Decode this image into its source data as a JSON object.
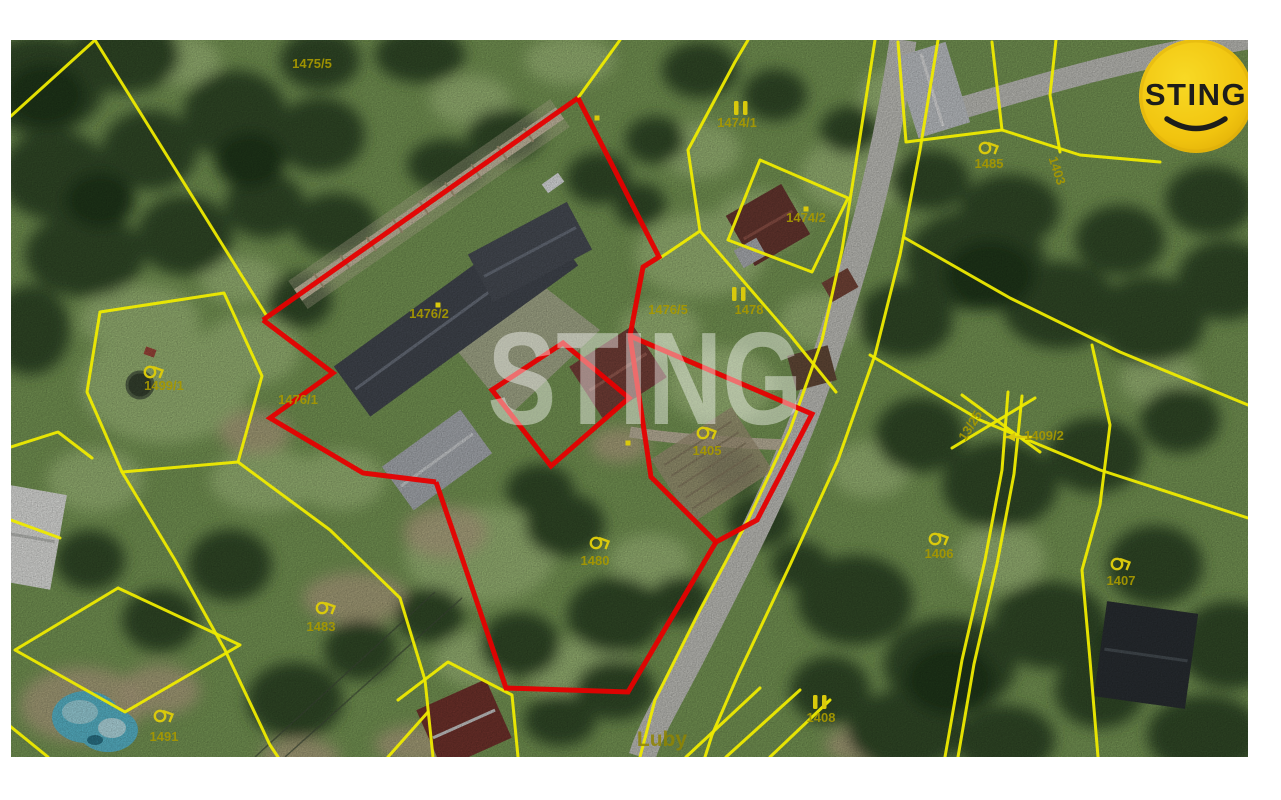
{
  "map": {
    "colors": {
      "parcel_line": "#eeea00",
      "parcel_label": "#a59700",
      "parcel_label_bright": "#d9c90c",
      "highlight_outline": "#e60000",
      "watermark": "rgba(255,255,255,0.42)",
      "road": "#cfcfc9",
      "place_label_color": "#8f8400"
    },
    "watermark_text": "STING",
    "place_label": {
      "text": "Luby",
      "x": 662,
      "y": 746
    },
    "labels": [
      {
        "text": "1475/5",
        "x": 312,
        "y": 68
      },
      {
        "text": "1474/1",
        "x": 737,
        "y": 127
      },
      {
        "text": "1474/2",
        "x": 806,
        "y": 222
      },
      {
        "text": "1476/2",
        "x": 429,
        "y": 318
      },
      {
        "text": "1476/5",
        "x": 668,
        "y": 314
      },
      {
        "text": "1478",
        "x": 749,
        "y": 314
      },
      {
        "text": "1476/1",
        "x": 298,
        "y": 404
      },
      {
        "text": "1499/1",
        "x": 164,
        "y": 390
      },
      {
        "text": "1405",
        "x": 707,
        "y": 455
      },
      {
        "text": "1480",
        "x": 595,
        "y": 565
      },
      {
        "text": "1483",
        "x": 321,
        "y": 631
      },
      {
        "text": "1491",
        "x": 164,
        "y": 741
      },
      {
        "text": "1406",
        "x": 939,
        "y": 558
      },
      {
        "text": "1407",
        "x": 1121,
        "y": 585
      },
      {
        "text": "1409/2",
        "x": 1044,
        "y": 440
      },
      {
        "text": "13/25",
        "x": 974,
        "y": 428,
        "rot": -58
      },
      {
        "text": "1403",
        "x": 1053,
        "y": 172,
        "rot": 72
      },
      {
        "text": "1485",
        "x": 989,
        "y": 168
      },
      {
        "text": "1408",
        "x": 821,
        "y": 722
      }
    ],
    "double_bar_marks": [
      [
        741,
        108
      ],
      [
        739,
        294
      ],
      [
        820,
        702
      ],
      [
        1229,
        62
      ]
    ],
    "dot_marks": [
      [
        438,
        305
      ],
      [
        806,
        209
      ],
      [
        597,
        118
      ],
      [
        628,
        443
      ]
    ],
    "orchard_symbols": [
      [
        150,
        372
      ],
      [
        703,
        433
      ],
      [
        596,
        543
      ],
      [
        322,
        608
      ],
      [
        160,
        716
      ],
      [
        935,
        539
      ],
      [
        1117,
        564
      ],
      [
        985,
        148
      ]
    ],
    "arrow": {
      "from": [
        1032,
        437
      ],
      "to": [
        1006,
        437
      ]
    },
    "parcel_lines": [
      [
        [
          95,
          40
        ],
        [
          268,
          318
        ]
      ],
      [
        [
          11,
          116
        ],
        [
          95,
          40
        ]
      ],
      [
        [
          100,
          312
        ],
        [
          224,
          293
        ],
        [
          262,
          376
        ],
        [
          238,
          462
        ],
        [
          122,
          472
        ],
        [
          87,
          392
        ],
        [
          100,
          312
        ]
      ],
      [
        [
          238,
          462
        ],
        [
          330,
          530
        ],
        [
          400,
          598
        ],
        [
          425,
          680
        ],
        [
          433,
          757
        ]
      ],
      [
        [
          122,
          472
        ],
        [
          175,
          560
        ],
        [
          225,
          650
        ],
        [
          270,
          745
        ],
        [
          278,
          757
        ]
      ],
      [
        [
          118,
          588
        ],
        [
          240,
          645
        ],
        [
          125,
          712
        ],
        [
          15,
          650
        ],
        [
          118,
          588
        ]
      ],
      [
        [
          0,
          718
        ],
        [
          48,
          757
        ]
      ],
      [
        [
          11,
          447
        ],
        [
          58,
          432
        ],
        [
          92,
          458
        ]
      ],
      [
        [
          11,
          520
        ],
        [
          60,
          538
        ]
      ],
      [
        [
          620,
          40
        ],
        [
          578,
          98
        ]
      ],
      [
        [
          660,
          258
        ],
        [
          700,
          231
        ],
        [
          790,
          335
        ],
        [
          836,
          392
        ]
      ],
      [
        [
          700,
          231
        ],
        [
          688,
          150
        ],
        [
          735,
          62
        ],
        [
          748,
          40
        ]
      ],
      [
        [
          760,
          160
        ],
        [
          848,
          198
        ],
        [
          812,
          272
        ],
        [
          728,
          240
        ],
        [
          760,
          160
        ]
      ],
      [
        [
          875,
          40
        ],
        [
          858,
          150
        ],
        [
          842,
          250
        ],
        [
          822,
          340
        ],
        [
          790,
          430
        ],
        [
          748,
          520
        ],
        [
          700,
          610
        ],
        [
          655,
          700
        ],
        [
          640,
          757
        ]
      ],
      [
        [
          938,
          40
        ],
        [
          920,
          150
        ],
        [
          900,
          255
        ],
        [
          875,
          355
        ],
        [
          838,
          460
        ],
        [
          790,
          565
        ],
        [
          738,
          675
        ],
        [
          712,
          735
        ],
        [
          705,
          757
        ]
      ],
      [
        [
          898,
          42
        ],
        [
          906,
          142
        ],
        [
          1002,
          130
        ],
        [
          992,
          42
        ]
      ],
      [
        [
          1002,
          130
        ],
        [
          1080,
          155
        ],
        [
          1160,
          162
        ]
      ],
      [
        [
          1056,
          40
        ],
        [
          1050,
          95
        ],
        [
          1060,
          152
        ]
      ],
      [
        [
          905,
          238
        ],
        [
          1010,
          298
        ],
        [
          1120,
          352
        ],
        [
          1248,
          405
        ]
      ],
      [
        [
          870,
          355
        ],
        [
          980,
          420
        ],
        [
          1100,
          470
        ],
        [
          1248,
          518
        ]
      ],
      [
        [
          1008,
          392
        ],
        [
          1002,
          470
        ],
        [
          985,
          560
        ],
        [
          962,
          660
        ],
        [
          945,
          757
        ]
      ],
      [
        [
          1022,
          396
        ],
        [
          1014,
          474
        ],
        [
          997,
          564
        ],
        [
          974,
          664
        ],
        [
          958,
          757
        ]
      ],
      [
        [
          952,
          448
        ],
        [
          1035,
          398
        ]
      ],
      [
        [
          962,
          395
        ],
        [
          1040,
          452
        ]
      ],
      [
        [
          1092,
          345
        ],
        [
          1110,
          425
        ],
        [
          1100,
          505
        ],
        [
          1082,
          570
        ],
        [
          1090,
          660
        ],
        [
          1098,
          757
        ]
      ],
      [
        [
          686,
          757
        ],
        [
          760,
          688
        ]
      ],
      [
        [
          726,
          757
        ],
        [
          800,
          690
        ]
      ],
      [
        [
          770,
          757
        ],
        [
          830,
          700
        ]
      ],
      [
        [
          398,
          700
        ],
        [
          448,
          662
        ],
        [
          512,
          695
        ],
        [
          518,
          757
        ]
      ],
      [
        [
          388,
          757
        ],
        [
          428,
          712
        ]
      ]
    ],
    "red_outlines": [
      {
        "points": [
          [
            578,
            98
          ],
          [
            263,
            320
          ]
        ],
        "closed": false
      },
      {
        "points": [
          [
            578,
            98
          ],
          [
            659,
            257
          ],
          [
            643,
            267
          ],
          [
            630,
            336
          ]
        ],
        "closed": false
      },
      {
        "points": [
          [
            263,
            320
          ],
          [
            333,
            373
          ],
          [
            270,
            418
          ],
          [
            363,
            473
          ],
          [
            436,
            482
          ]
        ],
        "closed": false
      },
      {
        "points": [
          [
            492,
            390
          ],
          [
            563,
            343
          ],
          [
            629,
            398
          ],
          [
            551,
            466
          ]
        ],
        "closed": true
      },
      {
        "points": [
          [
            630,
            336
          ],
          [
            812,
            414
          ],
          [
            757,
            520
          ],
          [
            716,
            542
          ],
          [
            651,
            477
          ],
          [
            630,
            336
          ]
        ],
        "closed": false
      },
      {
        "points": [
          [
            436,
            482
          ],
          [
            459,
            549
          ],
          [
            506,
            688
          ],
          [
            628,
            692
          ],
          [
            716,
            542
          ]
        ],
        "closed": false
      }
    ]
  },
  "logo": {
    "text": "STING",
    "bg": "#f1c40f",
    "fg": "#1d1d1b",
    "cx": 1196,
    "cy": 96,
    "r": 57
  }
}
